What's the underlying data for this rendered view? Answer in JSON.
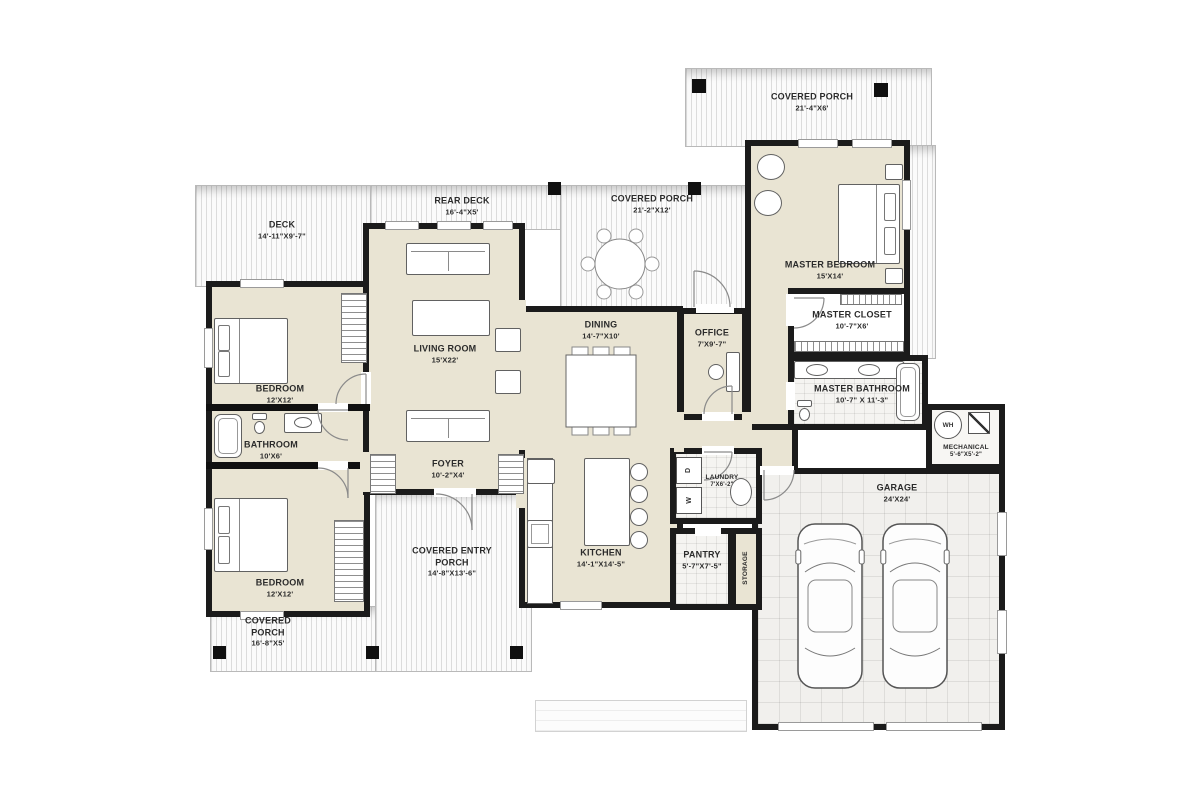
{
  "plan": {
    "type": "residential-floor-plan",
    "rooms": [
      {
        "id": "deck",
        "label": "DECK",
        "dims": "14'-11\"X9'-7\""
      },
      {
        "id": "rear-deck",
        "label": "REAR DECK",
        "dims": "16'-4\"X5'"
      },
      {
        "id": "covered-porch-top",
        "label": "COVERED PORCH",
        "dims": "21'-2\"X12'"
      },
      {
        "id": "covered-porch-right",
        "label": "COVERED PORCH",
        "dims": "21'-4\"X6'"
      },
      {
        "id": "living-room",
        "label": "LIVING ROOM",
        "dims": "15'X22'"
      },
      {
        "id": "dining",
        "label": "DINING",
        "dims": "14'-7\"X10'"
      },
      {
        "id": "office",
        "label": "OFFICE",
        "dims": "7'X9'-7\""
      },
      {
        "id": "master-bedroom",
        "label": "MASTER BEDROOM",
        "dims": "15'X14'"
      },
      {
        "id": "master-closet",
        "label": "MASTER CLOSET",
        "dims": "10'-7\"X6'"
      },
      {
        "id": "master-bathroom",
        "label": "MASTER BATHROOM",
        "dims": "10'-7\" X 11'-3\""
      },
      {
        "id": "bedroom-1",
        "label": "BEDROOM",
        "dims": "12'X12'"
      },
      {
        "id": "bathroom",
        "label": "BATHROOM",
        "dims": "10'X6'"
      },
      {
        "id": "bedroom-2",
        "label": "BEDROOM",
        "dims": "12'X12'"
      },
      {
        "id": "foyer",
        "label": "FOYER",
        "dims": "10'-2\"X4'"
      },
      {
        "id": "kitchen",
        "label": "KITCHEN",
        "dims": "14'-1\"X14'-5\""
      },
      {
        "id": "laundry",
        "label": "LAUNDRY",
        "dims": "7'X6'-2\""
      },
      {
        "id": "pantry",
        "label": "PANTRY",
        "dims": "5'-7\"X7'-5\""
      },
      {
        "id": "storage",
        "label": "STORAGE",
        "dims": ""
      },
      {
        "id": "mechanical",
        "label": "MECHANICAL",
        "dims": "5'-6\"X5'-2\""
      },
      {
        "id": "garage",
        "label": "GARAGE",
        "dims": "24'X24'"
      },
      {
        "id": "covered-entry-porch",
        "label": "COVERED ENTRY PORCH",
        "dims": "14'-8\"X13'-6\""
      },
      {
        "id": "covered-porch-bottom",
        "label": "COVERED PORCH",
        "dims": "16'-8\"X5'"
      }
    ],
    "appliances": {
      "washer": "W",
      "dryer": "D",
      "water_heater": "WH"
    },
    "colors": {
      "wall": "#1b1b1b",
      "floor": "#e9e4d3",
      "deck_stripe": "#c9c9c9",
      "tile": "#f5f4f1"
    }
  }
}
